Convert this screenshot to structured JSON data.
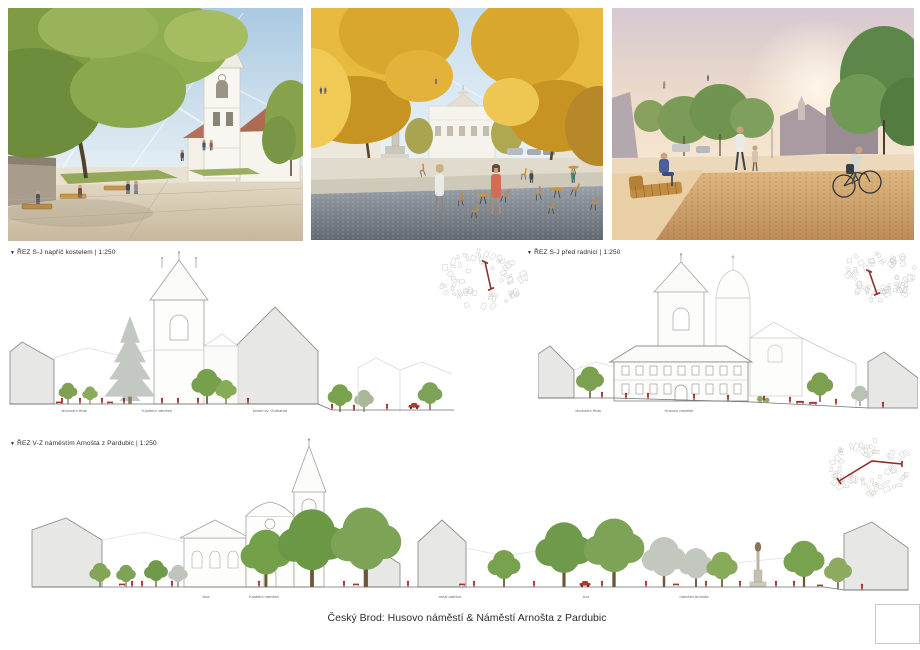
{
  "board": {
    "title": "Český Brod: Husovo náměstí & Náměstí Arnošta z Pardubic"
  },
  "sections": [
    {
      "marker": "▼",
      "label": "ŘEZ S-J napříč kostelem | 1:250",
      "sublabels": [
        "obchodní třída",
        "Kostelní náměstí",
        "kostel sv. Gotharda"
      ]
    },
    {
      "marker": "▼",
      "label": "ŘEZ S-J před radnicí | 1:250",
      "sublabels": [
        "obchodní třída",
        "Husovo náměstí"
      ]
    },
    {
      "marker": "▼",
      "label": "ŘEZ V-Z náměstím Arnošta z Pardubic | 1:250",
      "sublabels": [
        "fara",
        "Kostelní náměstí",
        "areál radnice",
        "tvrz",
        "náměstí Arnošta"
      ]
    }
  ],
  "colors": {
    "section_red": "#a23530",
    "plan_red": "#8e2f2a",
    "tree_green": "#7da357",
    "tree_gray": "#c2c7c0",
    "silhouette_gray": "#e7e7e5",
    "outline_gray": "#8f8f8d",
    "wood": "#c08a3e"
  }
}
